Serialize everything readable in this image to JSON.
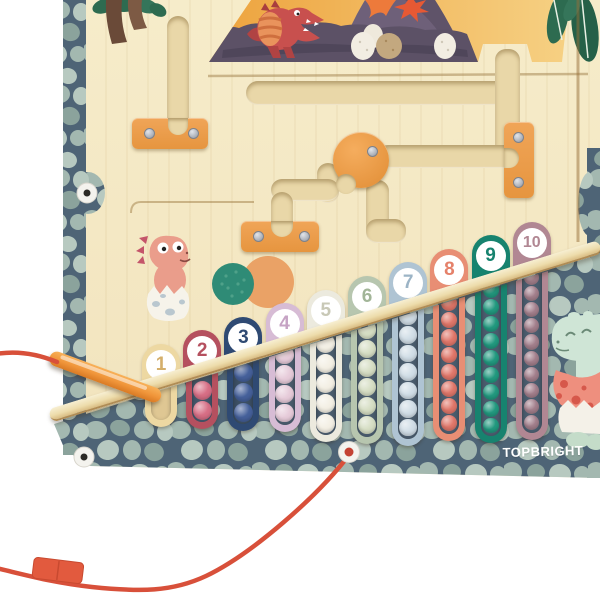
{
  "brand": {
    "logo_text": "TOPBRIGHT",
    "logo_color": "#ffffff"
  },
  "board": {
    "wood_color": "#f3e6c1",
    "channel_color": "#e9d7a8",
    "rail_color": "#eddcab",
    "pebble_background": "#4e6476",
    "pebble_stone_colors": [
      "#a3b8b0",
      "#8ba39c",
      "#b7c9c0"
    ]
  },
  "columns": [
    {
      "number": "1",
      "color": "#edd8a2",
      "numeral_color": "#d4af6b",
      "bead_color": "#e8c98f",
      "slot_color": "#dfc793",
      "beads_visible": 0
    },
    {
      "number": "2",
      "color": "#b5505f",
      "numeral_color": "#b5505f",
      "bead_color": "#d76e85",
      "slot_color": "#43566a",
      "beads_visible": 2
    },
    {
      "number": "3",
      "color": "#2f4a73",
      "numeral_color": "#2f4a73",
      "bead_color": "#45609a",
      "slot_color": "#3c4f63",
      "beads_visible": 3
    },
    {
      "number": "4",
      "color": "#d7bcd5",
      "numeral_color": "#c6a3c4",
      "bead_color": "#e6cbd9",
      "slot_color": "#4a5c6d",
      "beads_visible": 4
    },
    {
      "number": "5",
      "color": "#eceade",
      "numeral_color": "#c8c8b6",
      "bead_color": "#f3efe4",
      "slot_color": "#4a5c6d",
      "beads_visible": 5
    },
    {
      "number": "6",
      "color": "#b7c6af",
      "numeral_color": "#a2b598",
      "bead_color": "#d6dec4",
      "slot_color": "#4a5c6d",
      "beads_visible": 6
    },
    {
      "number": "7",
      "color": "#afc4d3",
      "numeral_color": "#9cb4c6",
      "bead_color": "#d0dde6",
      "slot_color": "#4a5c6d",
      "beads_visible": 7
    },
    {
      "number": "8",
      "color": "#e88e74",
      "numeral_color": "#e5816a",
      "bead_color": "#e0776a",
      "slot_color": "#4a5c6d",
      "beads_visible": 8
    },
    {
      "number": "9",
      "color": "#17836f",
      "numeral_color": "#17836f",
      "bead_color": "#22997f",
      "slot_color": "#4a5c6d",
      "beads_visible": 9
    },
    {
      "number": "10",
      "color": "#b18793",
      "numeral_color": "#b18793",
      "bead_color": "#a37f8c",
      "slot_color": "#4a5c6d",
      "beads_visible": 10
    }
  ],
  "hardware": {
    "bracket_color": "#eb9d4c",
    "knob_color": "#eda14f",
    "screw_color": "#b6bac2",
    "grommet_color": "#f4f3ee"
  },
  "accessories": {
    "pen_color": "#f0953a",
    "cord_color": "#d8503a",
    "cord_clip_color": "#e25a3e"
  },
  "scene": {
    "sky_colors": [
      "#eda23c",
      "#f6d184"
    ],
    "ground_color": "#5c5166",
    "trex_color": "#c8504e",
    "trex_belly_color": "#e9935c",
    "volcano_color": "#6e6079",
    "lava_color": "#ed7a3b",
    "egg_colors": [
      "#f2ede2",
      "#c3a87f"
    ],
    "palm_trunk_color": "#6a4a38",
    "foliage_color": "#2d6b50"
  },
  "characters": {
    "pink_dino_color": "#ea9d8b",
    "pink_dino_spike_color": "#c4556a",
    "mint_dino_color": "#cfe5d6",
    "shell_color": "#ee8f7e",
    "shell_spot_color": "#d6584b"
  }
}
